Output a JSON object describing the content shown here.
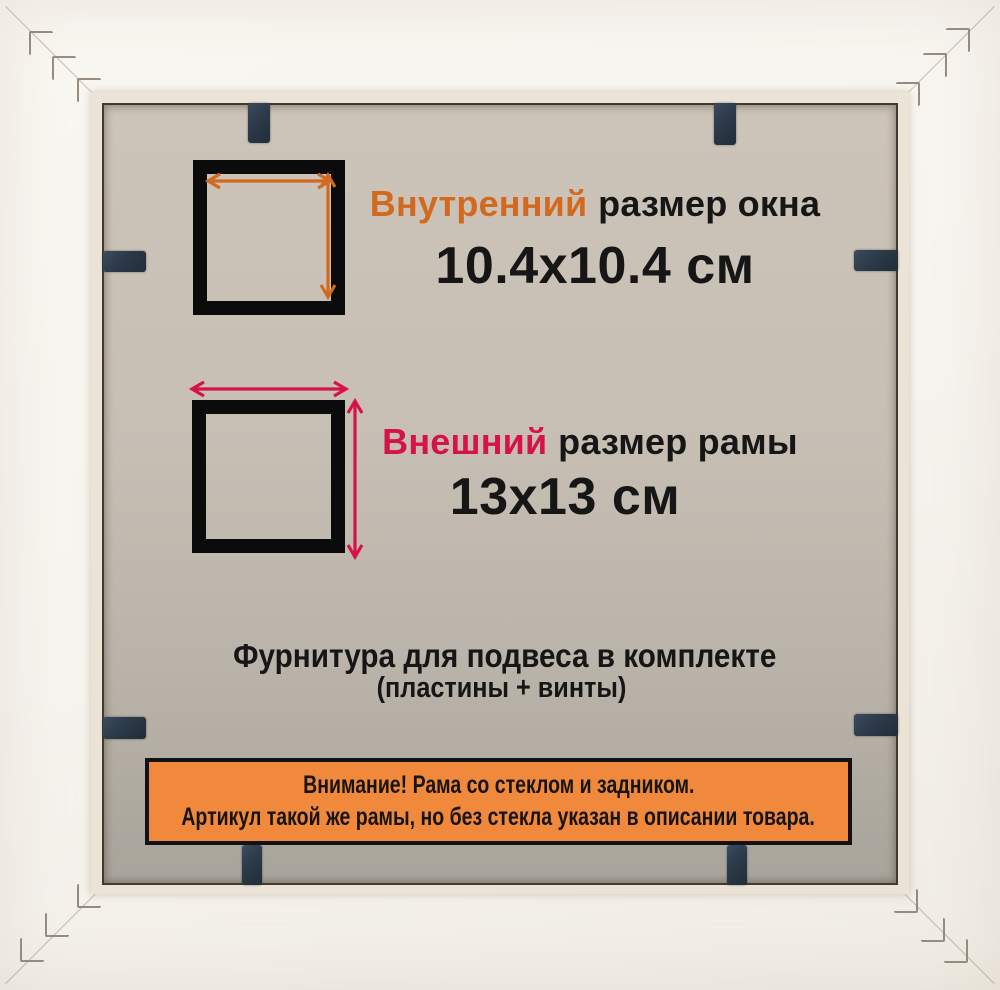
{
  "dimensions": {
    "inner": {
      "label_accent": "Внутренний",
      "label_rest": "размер окна",
      "value": "10.4x10.4 см"
    },
    "outer": {
      "label_accent": "Внешний",
      "label_rest": "размер рамы",
      "value": "13x13 см"
    }
  },
  "hardware": {
    "title": "Фурнитура для подвеса в комплекте",
    "subtitle": "(пластины + винты)"
  },
  "warning": {
    "line1": "Внимание! Рама со стеклом и задником.",
    "line2": "Артикул такой же рамы, но без стекла указан в описании товара."
  },
  "colors": {
    "inner_accent": "#d2691e",
    "outer_accent": "#d5134a",
    "banner_bg": "#f0893c",
    "banner_border": "#121212",
    "board_top": "#ccc4b8",
    "board_bottom": "#a8a49b",
    "clip": "#2c3a49",
    "square_border": "#0b0b0b",
    "text": "#161616"
  }
}
